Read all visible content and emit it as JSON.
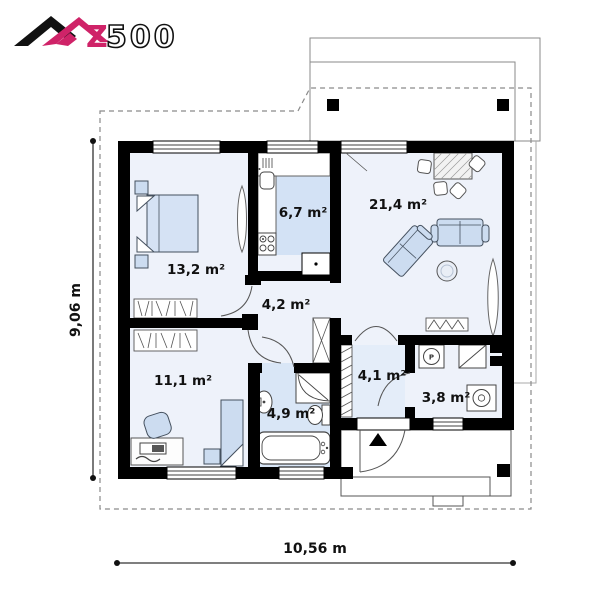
{
  "logo": {
    "z": "Z",
    "numbers": "500"
  },
  "rooms": {
    "bedroom": {
      "name": "bedroom",
      "label": "13,2 m²"
    },
    "kitchen": {
      "name": "kitchen",
      "label": "6,7 m²"
    },
    "living": {
      "name": "living-room",
      "label": "21,4 m²"
    },
    "hall": {
      "name": "hall",
      "label": "4,2 m²"
    },
    "office": {
      "name": "second-bedroom",
      "label": "11,1 m²"
    },
    "bathroom": {
      "name": "bathroom",
      "label": "4,9 m²"
    },
    "vestibule": {
      "name": "vestibule",
      "label": "4,1 m²"
    },
    "utility": {
      "name": "utility-room",
      "label": "3,8 m²"
    }
  },
  "dimensions": {
    "height": "9,06 m",
    "width": "10,56 m"
  },
  "annotations": {
    "boiler_letter": "P"
  },
  "colors": {
    "accent": "#cf2368",
    "wall": "#000000",
    "floor": "#eef2fa",
    "floor_tint": "#d9e6f6",
    "furniture": "#ccdcf0",
    "outline_dash": "#8a8a8a"
  }
}
